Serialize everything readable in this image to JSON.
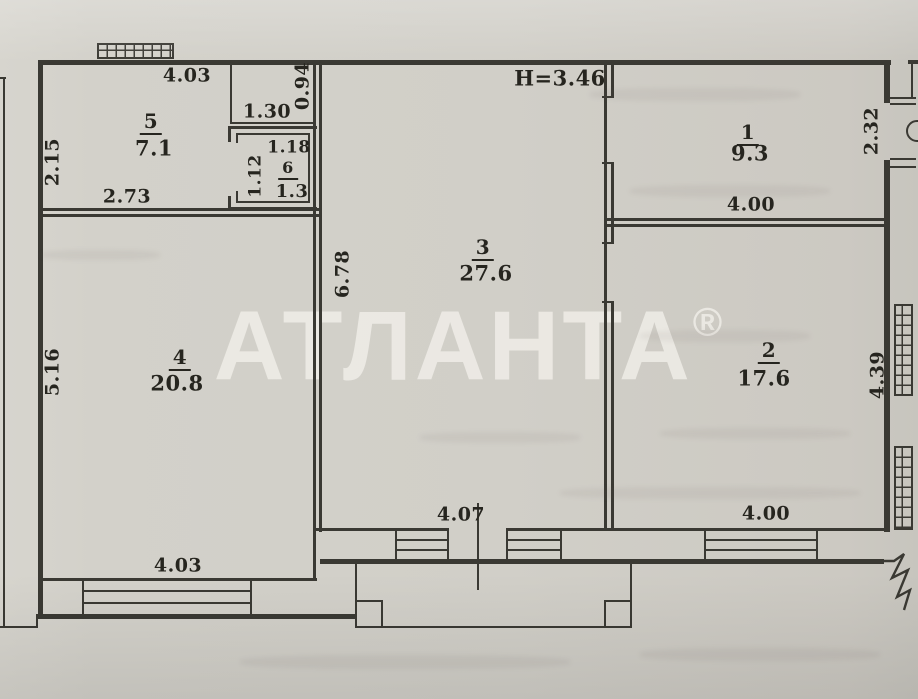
{
  "watermark": {
    "text": "АТЛАНТА",
    "registered": "®"
  },
  "plan": {
    "height_note": "H=3.46",
    "rooms": {
      "r1": {
        "number": "1",
        "area": "9.3"
      },
      "r2": {
        "number": "2",
        "area": "17.6"
      },
      "r3": {
        "number": "3",
        "area": "27.6"
      },
      "r4": {
        "number": "4",
        "area": "20.8"
      },
      "r5": {
        "number": "5",
        "area": "7.1"
      },
      "r6": {
        "number": "6",
        "area": "1.3"
      }
    },
    "dimensions": {
      "top_width": "4.03",
      "niche_depth": "0.94",
      "niche_width": "1.30",
      "room5_left": "2.15",
      "room5_bottom": "2.73",
      "room6_width": "1.18",
      "room6_height": "1.12",
      "room3_height": "6.78",
      "room3_bottom": "4.07",
      "room1_right": "2.32",
      "room1_bottom": "4.00",
      "room2_right": "4.39",
      "room2_bottom": "4.00",
      "room4_left": "5.16",
      "room4_bottom": "4.03"
    }
  }
}
